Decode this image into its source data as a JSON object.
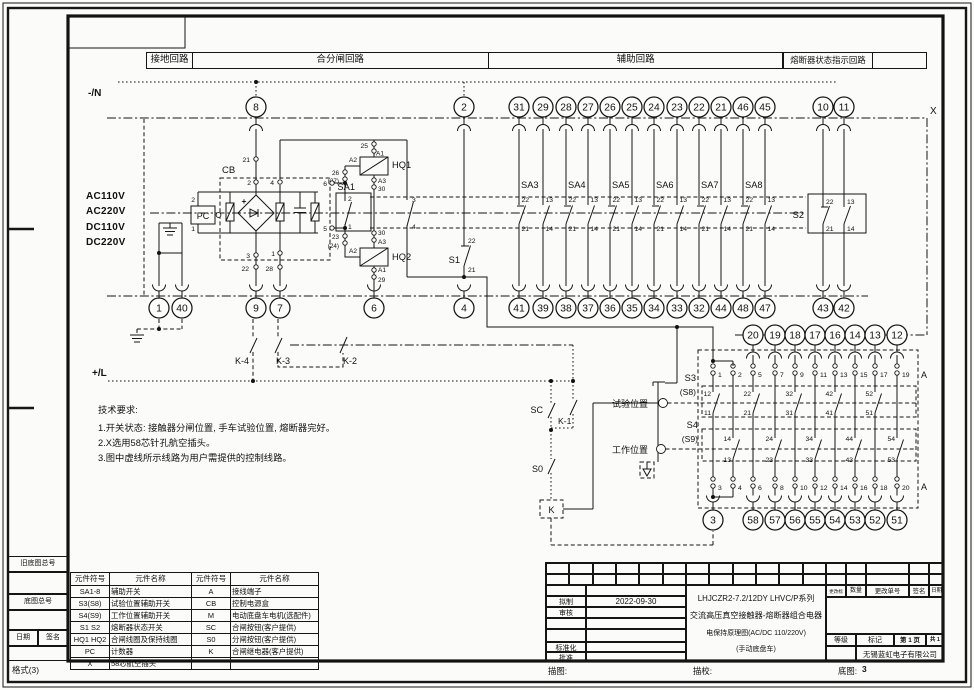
{
  "sheet": {
    "header_cells": [
      "接地回路",
      "合分闸回路",
      "辅助回路",
      "熔断器状态指示回路",
      ""
    ],
    "margin": {
      "old_base_no": "旧底图总号",
      "base_no": "底图总号",
      "date": "日期",
      "sign": "签名",
      "format": "格式(3)"
    },
    "bottom_strip": {
      "trace": "描图:",
      "trace_check": "描校:",
      "base": "底图:",
      "base_val": "3"
    }
  },
  "buses": {
    "neg": "-/N",
    "pos": "+/L",
    "connector": "X",
    "block_connector": "A",
    "voltages": [
      "AC110V",
      "AC220V",
      "DC110V",
      "DC220V"
    ]
  },
  "terminals": {
    "top": [
      "8",
      "2",
      "31",
      "29",
      "28",
      "27",
      "26",
      "25",
      "24",
      "23",
      "22",
      "21",
      "46",
      "45",
      "10",
      "11"
    ],
    "bottom": [
      "1",
      "40",
      "9",
      "7",
      "6",
      "4",
      "41",
      "39",
      "38",
      "37",
      "36",
      "35",
      "34",
      "33",
      "32",
      "44",
      "48",
      "47",
      "43",
      "42"
    ],
    "block_top": [
      "20",
      "19",
      "18",
      "17",
      "16",
      "14",
      "13",
      "12"
    ],
    "block_bottom": [
      "3",
      "58",
      "57",
      "56",
      "55",
      "54",
      "53",
      "52",
      "51"
    ]
  },
  "aux": {
    "names": [
      "SA3",
      "SA4",
      "SA5",
      "SA6",
      "SA7",
      "SA8"
    ],
    "nc": [
      "22",
      "21"
    ],
    "no": [
      "13",
      "14"
    ],
    "s2": "S2",
    "s1": "S1",
    "s1_pins": [
      "22",
      "21"
    ]
  },
  "cb": {
    "name": "CB",
    "plus": "+",
    "pc": "PC",
    "pc_pins": [
      "2",
      "1"
    ],
    "col_left_pins": [
      "21",
      "2",
      "3",
      "22"
    ],
    "col_right_pins": [
      "4",
      "1",
      "28"
    ],
    "edge_pins": [
      "6",
      "5"
    ]
  },
  "hq": {
    "hq1": "HQ1",
    "hq2": "HQ2",
    "sa1": "SA1",
    "hq1_top_pin": "25",
    "hq1_pins": [
      "A1",
      "A2",
      "A3",
      "30"
    ],
    "hq2_pins": [
      "30",
      "A3",
      "A2",
      "A1",
      "29"
    ],
    "sa1_pins": [
      "2",
      "1"
    ],
    "wire_nums": [
      "26",
      "(27)",
      "23",
      "(24)"
    ],
    "branch_pins": [
      "3",
      "4"
    ]
  },
  "relay": {
    "k4": "K-4",
    "k3": "K-3",
    "k2": "K-2",
    "k1": "K-1",
    "sc": "SC",
    "s0": "S0",
    "k": "K"
  },
  "block": {
    "s3": "S3",
    "s3_alt": "(S8)",
    "s4": "S4",
    "s4_alt": "(S9)",
    "test_pos": "试验位置",
    "work_pos": "工作位置",
    "top_pins": [
      "1",
      "2",
      "5",
      "7",
      "9",
      "11",
      "13",
      "15",
      "17",
      "19"
    ],
    "bottom_pins": [
      "3",
      "4",
      "6",
      "8",
      "10",
      "12",
      "14",
      "16",
      "18",
      "20"
    ],
    "s3_contacts": [
      [
        "12",
        "11"
      ],
      [
        "22",
        "21"
      ],
      [
        "32",
        "31"
      ],
      [
        "42",
        "41"
      ],
      [
        "52",
        "51"
      ]
    ],
    "s4_contacts": [
      [
        "14",
        "13"
      ],
      [
        "24",
        "23"
      ],
      [
        "34",
        "33"
      ],
      [
        "44",
        "43"
      ],
      [
        "54",
        "53"
      ]
    ]
  },
  "notes": {
    "title": "技术要求:",
    "lines": [
      "1.开关状态: 接触器分闸位置, 手车试验位置, 熔断器完好。",
      "2.X选用58芯针孔航空插头。",
      "3.图中虚线所示线路为用户需提供的控制线路。"
    ]
  },
  "parts_table": {
    "headers": [
      "元件符号",
      "元件名称",
      "元件符号",
      "元件名称"
    ],
    "rows": [
      [
        "SA1-8",
        "辅助开关",
        "A",
        "接线端子"
      ],
      [
        "S3(S8)",
        "试验位置辅助开关",
        "CB",
        "控制电源盒"
      ],
      [
        "S4(S9)",
        "工作位置辅助开关",
        "M",
        "电动底盘车电机(选配件)"
      ],
      [
        "S1 S2",
        "熔断器状态开关",
        "SC",
        "合闸按钮(客户提供)"
      ],
      [
        "HQ1 HQ2",
        "合闸线圈及保持线圈",
        "S0",
        "分闸按钮(客户提供)"
      ],
      [
        "PC",
        "计数器",
        "K",
        "合闸继电器(客户提供)"
      ],
      [
        "X",
        "58芯航空插头",
        "",
        ""
      ]
    ]
  },
  "title_block": {
    "drafted": "拟制",
    "date_value": "2022-09-30",
    "checked": "审核",
    "standardized": "标准化",
    "approved": "批准",
    "rev_mark": "更改标记",
    "qty": "数量",
    "rev_no": "更改单号",
    "sign": "签名",
    "date": "日期",
    "grade": "等级",
    "mark": "标记",
    "page": "第 1 页",
    "pages": "共 1 页",
    "company": "无锡蓝虹电子有限公司",
    "title_lines": [
      "LHJCZR2-7.2/12DY    LHVC/P系列",
      "交流高压真空接触器-熔断器组合电器",
      "电保持原理图(AC/DC 110/220V)",
      "(手动底盘车)"
    ]
  }
}
